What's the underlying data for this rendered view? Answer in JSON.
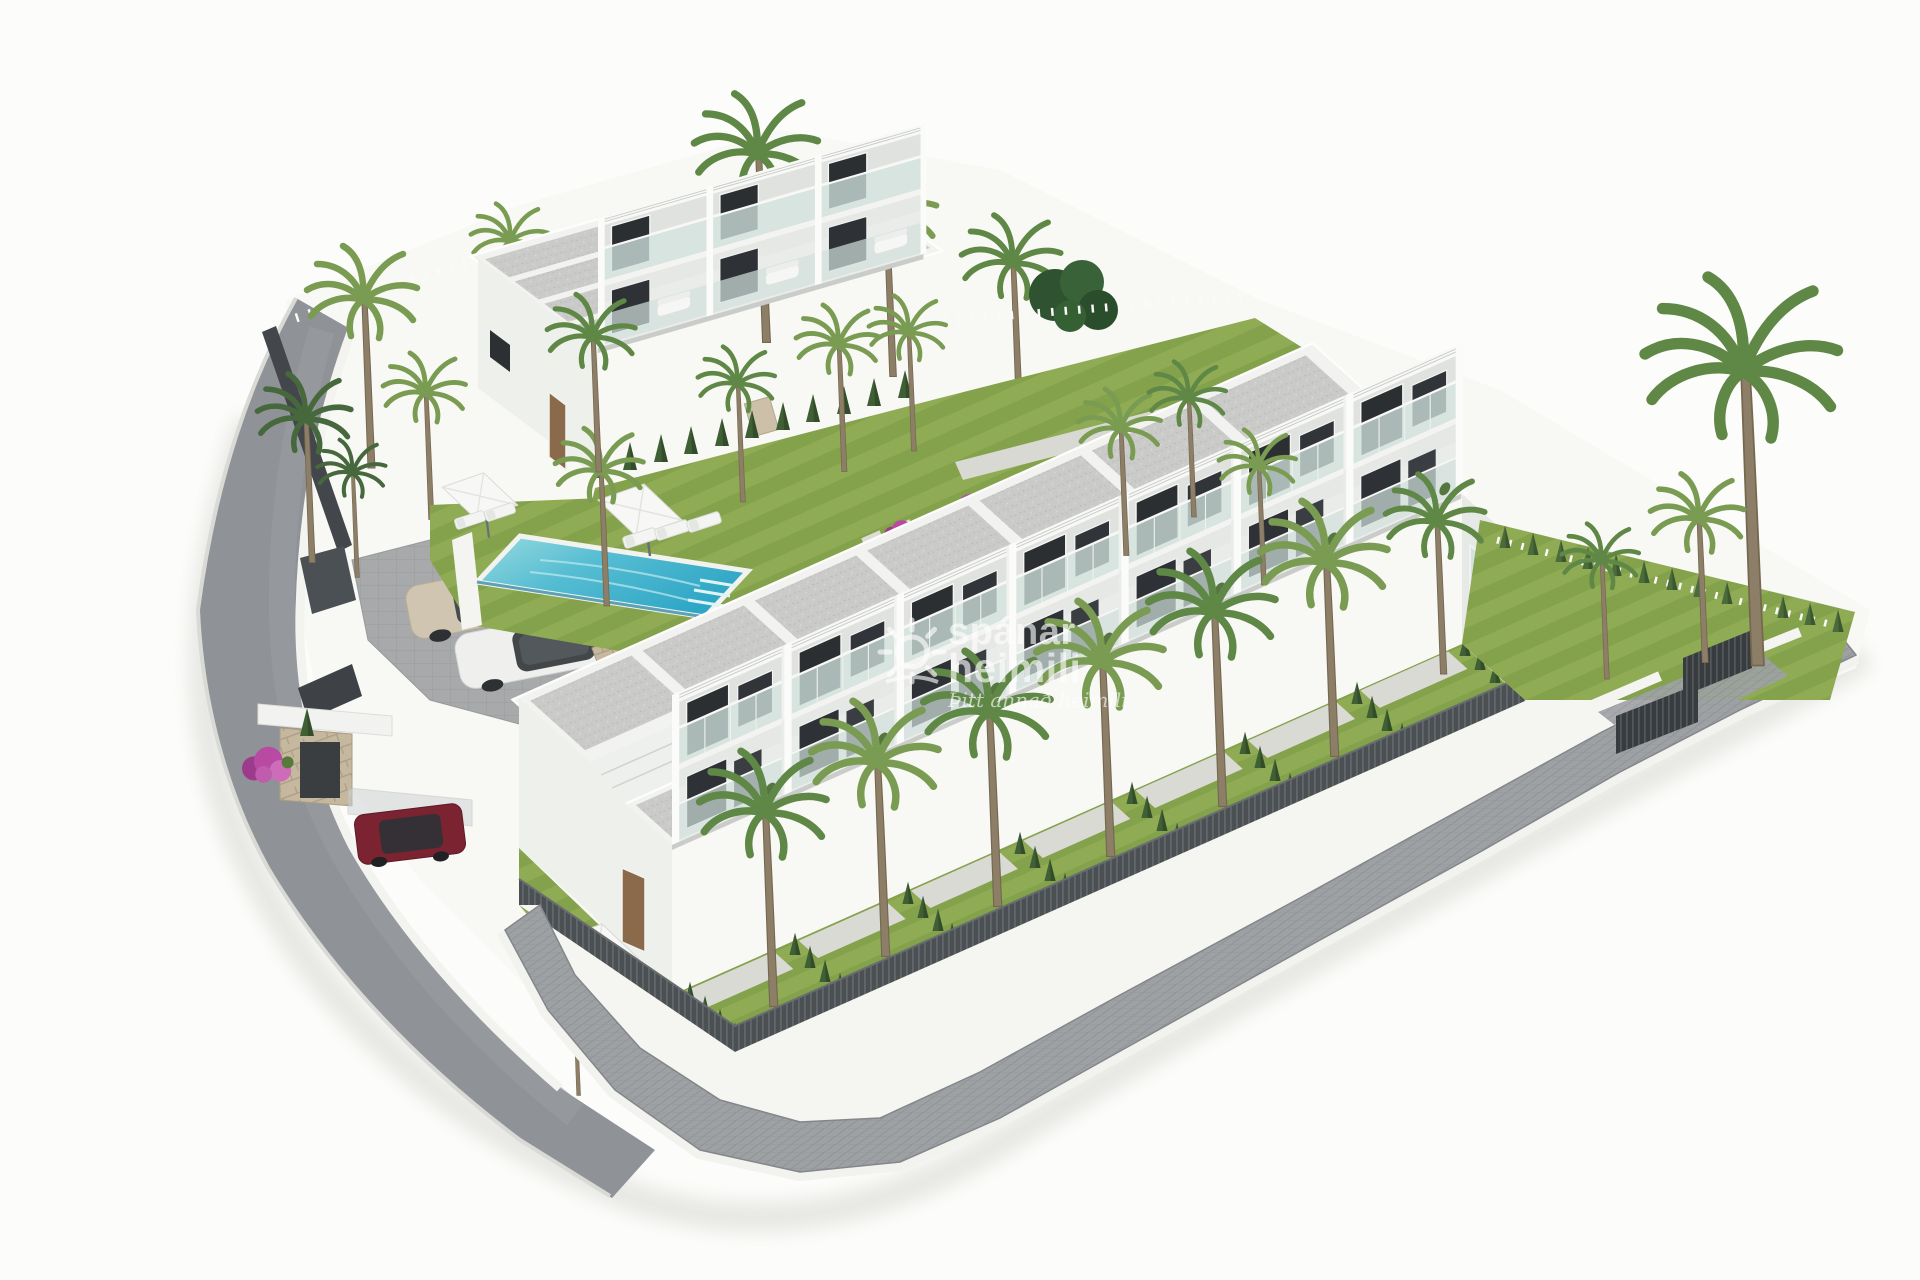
{
  "scene_alt": "Aerial 3D architectural rendering of a modern white two-storey townhouse development on a hillside corner plot, with gravel flat roofs, glass balconies, private gardens with palm trees and conifer hedges, a turquoise swimming pool with sun loungers and parasols, a small parking area with two cars, a red SUV under a carport, bougainvillea on a stone retaining wall, dark slatted perimeter fencing and curving grey roads and walkways.",
  "watermark": {
    "brand_top": "spánar",
    "brand_bottom": "heimili",
    "tagline": "Þitt annað heimili",
    "color": "#ffffff",
    "opacity": 0.62
  },
  "palette": {
    "background": "#fcfcfa",
    "road": "#8f9296",
    "walkway_pavers": "#9ea1a4",
    "parking_pavers": "#a7a9ab",
    "roof_gravel": "#cacbc8",
    "facade_white": "#f1f2ef",
    "facade_shadow": "#e7e9e6",
    "window_dark": "#2c3033",
    "balcony_glass": "#cfe0db",
    "lawn_green": "#84a14b",
    "lawn_light": "#8fac55",
    "hedge_dark": "#3f5f35",
    "palm_green": "#5f8746",
    "trunk_brown": "#8d7e68",
    "pool_shallow": "#9adbe0",
    "pool_deep": "#2ea6c6",
    "bougainvillea_magenta": "#b84aa4",
    "stone_wall_tan": "#c6b89e",
    "fence_dark": "#4a5053",
    "car_red": "#7b2331",
    "car_beige": "#cfc5b0",
    "car_white": "#eff0ee",
    "watermark_white": "#ffffff"
  }
}
